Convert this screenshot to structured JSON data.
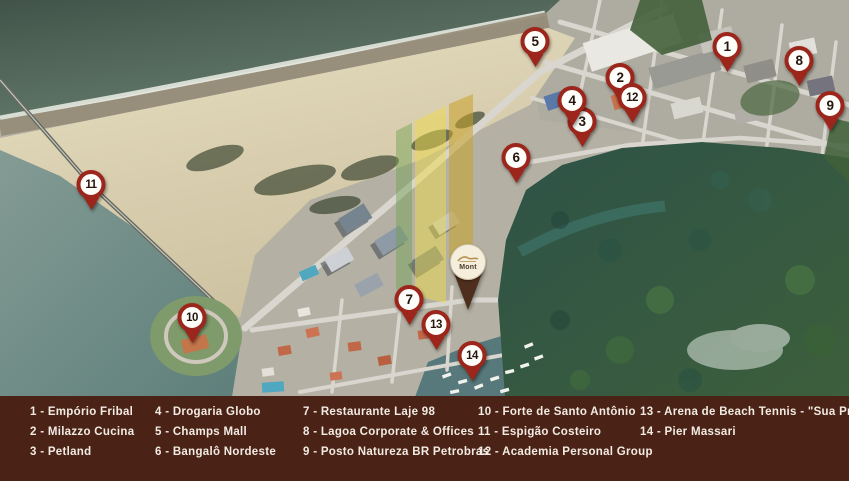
{
  "map": {
    "pins": [
      {
        "number": "1",
        "x": 727,
        "y": 47
      },
      {
        "number": "2",
        "x": 620,
        "y": 78
      },
      {
        "number": "3",
        "x": 582,
        "y": 122
      },
      {
        "number": "4",
        "x": 572,
        "y": 101
      },
      {
        "number": "5",
        "x": 535,
        "y": 42
      },
      {
        "number": "6",
        "x": 516,
        "y": 158
      },
      {
        "number": "7",
        "x": 409,
        "y": 300
      },
      {
        "number": "8",
        "x": 799,
        "y": 61
      },
      {
        "number": "9",
        "x": 830,
        "y": 106
      },
      {
        "number": "10",
        "x": 192,
        "y": 318
      },
      {
        "number": "11",
        "x": 91,
        "y": 185
      },
      {
        "number": "12",
        "x": 632,
        "y": 98
      },
      {
        "number": "13",
        "x": 436,
        "y": 325
      },
      {
        "number": "14",
        "x": 472,
        "y": 356
      }
    ],
    "development_pin": {
      "logo_text": "Mont",
      "x": 467,
      "y": 261
    },
    "watermark_colors": [
      "#6ea050",
      "#eed94a",
      "#c9a227"
    ]
  },
  "legend": {
    "separator": " - ",
    "columns": [
      {
        "x": 30,
        "items": [
          {
            "number": "1",
            "name": "Empório Fribal"
          },
          {
            "number": "2",
            "name": "Milazzo Cucina"
          },
          {
            "number": "3",
            "name": "Petland"
          }
        ]
      },
      {
        "x": 155,
        "items": [
          {
            "number": "4",
            "name": "Drogaria Globo"
          },
          {
            "number": "5",
            "name": "Champs Mall"
          },
          {
            "number": "6",
            "name": "Bangalô Nordeste"
          }
        ]
      },
      {
        "x": 303,
        "items": [
          {
            "number": "7",
            "name": "Restaurante Laje 98"
          },
          {
            "number": "8",
            "name": "Lagoa Corporate & Offices"
          },
          {
            "number": "9",
            "name": "Posto Natureza BR Petrobras"
          }
        ]
      },
      {
        "x": 478,
        "items": [
          {
            "number": "10",
            "name": "Forte de Santo Antônio"
          },
          {
            "number": "11",
            "name": "Espigão Costeiro"
          },
          {
            "number": "12",
            "name": "Academia Personal Group"
          }
        ]
      },
      {
        "x": 640,
        "items": [
          {
            "number": "13",
            "name": "Arena de Beach Tennis - \"Sua Praia\""
          },
          {
            "number": "14",
            "name": "Pier Massari"
          }
        ]
      }
    ]
  },
  "colors": {
    "legend_background": "#4b2316",
    "legend_text": "#f1ebe3",
    "pin_ring": "#9c261b",
    "pin_number": "#27140d",
    "development_pin_tail": "#4e2e1c",
    "development_pin_head": "#f6eedd"
  }
}
